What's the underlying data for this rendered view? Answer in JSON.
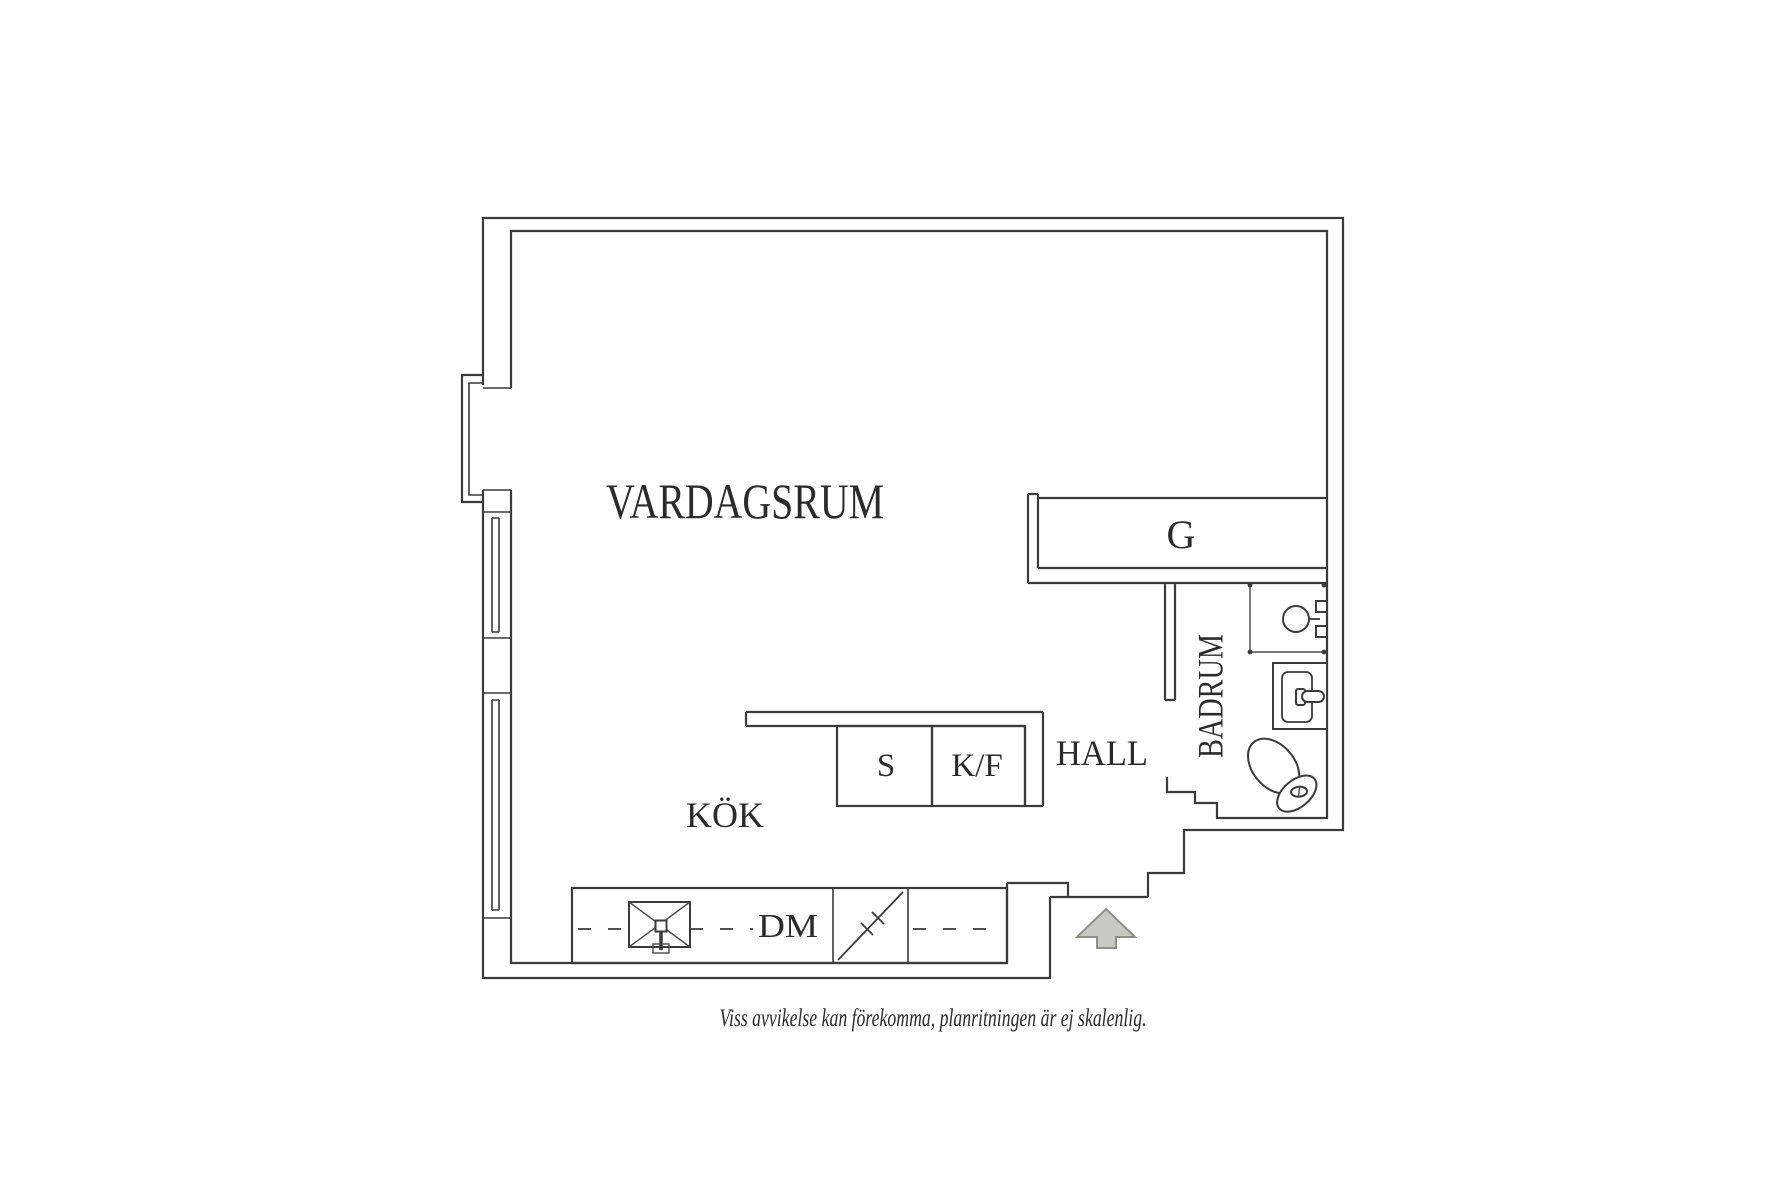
{
  "floorplan": {
    "rooms": {
      "living_room": "VARDAGSRUM",
      "kitchen": "KÖK",
      "hall": "HALL",
      "bathroom": "BADRUM",
      "closet": "G"
    },
    "appliances": {
      "stove": "S",
      "fridge_freezer": "K/F",
      "dishwasher": "DM"
    },
    "caption": "Viss avvikelse kan förekomma, planritningen är ej skalenlig.",
    "colors": {
      "line": "#3b3b3b",
      "thin_line": "#4a4a4a",
      "text": "#2b2b2b",
      "arrow_fill": "#c9c9c4",
      "arrow_stroke": "#8f8f8a",
      "background": "#ffffff"
    }
  }
}
